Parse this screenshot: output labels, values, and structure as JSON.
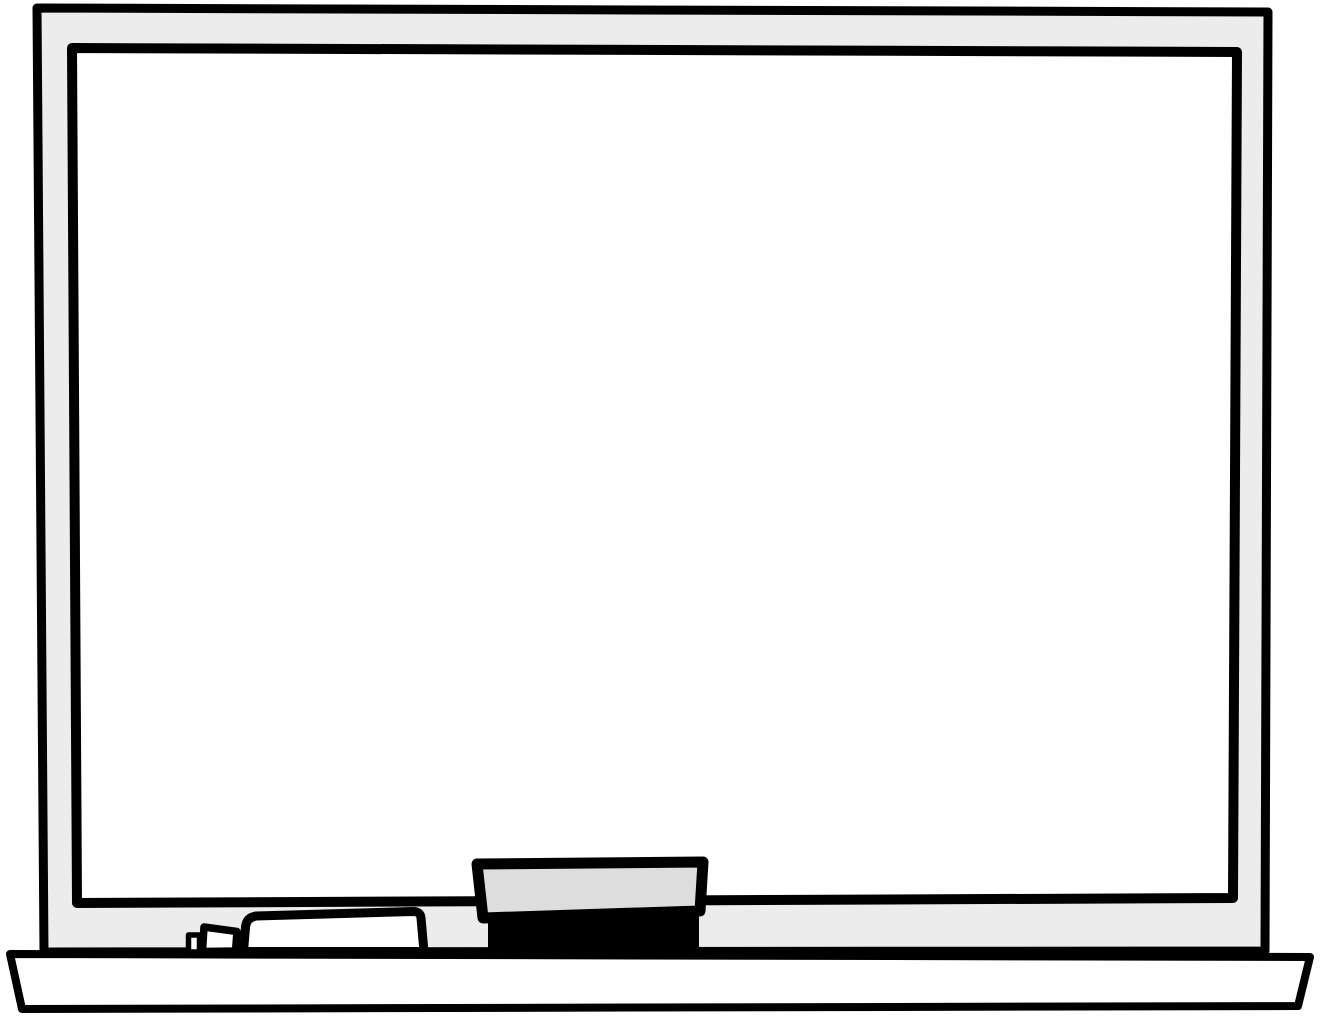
{
  "illustration": {
    "name": "whiteboard-clipart",
    "description": "Blank dry-erase whiteboard clipart: gray-framed white board, marker tray ledge below, a capped dry-erase marker lying on the tray and a chalk/whiteboard eraser resting against the board",
    "colors": {
      "background": "#ffffff",
      "outline": "#000000",
      "frame_fill": "#ececec",
      "board_surface_fill": "#ffffff",
      "tray_fill": "#ffffff",
      "marker_tip_fill": "#ffffff",
      "marker_cap_fill": "#ffffff",
      "marker_body_fill": "#ffffff",
      "eraser_body_fill": "#dddddd",
      "eraser_felt_fill": "#000000"
    },
    "objects": {
      "board_frame": "outer whiteboard frame",
      "board_surface": "blank white writing surface",
      "tray": "marker tray ledge",
      "marker": "dry-erase marker (tip, cap, body)",
      "eraser": "whiteboard eraser (gray handle, black felt pad)"
    }
  }
}
